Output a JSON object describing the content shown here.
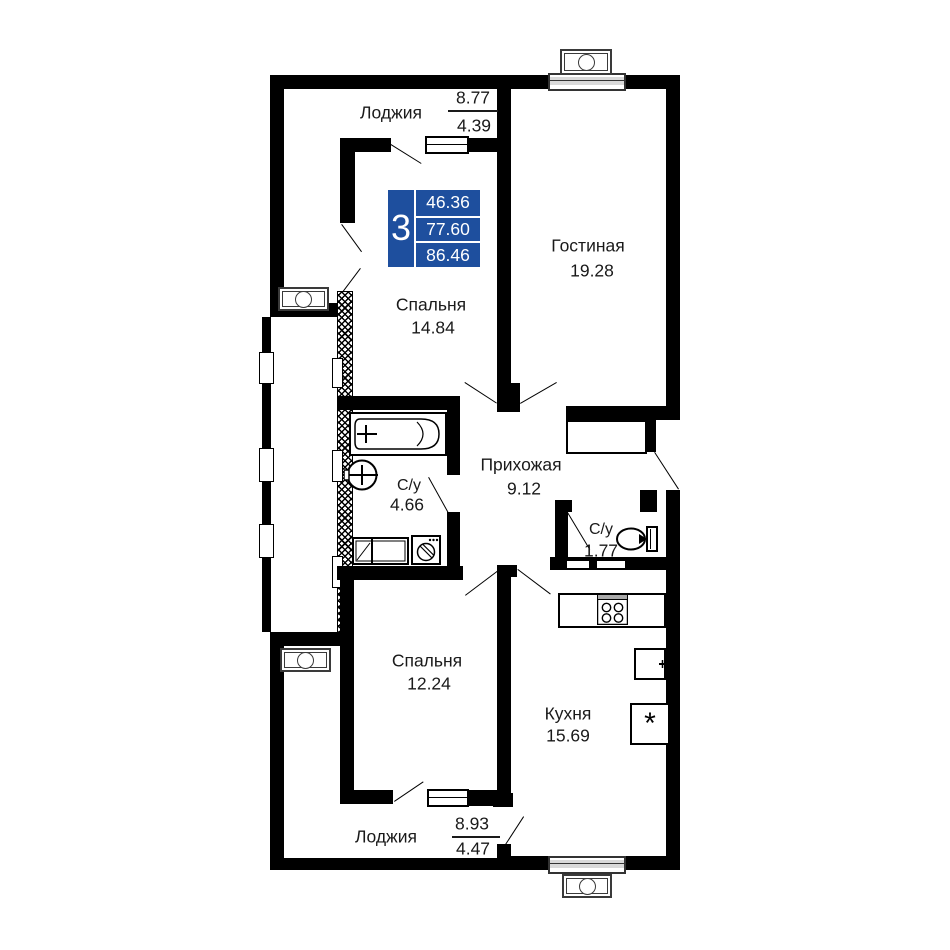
{
  "palette": {
    "wall": "#000000",
    "accent_blue": "#1e4f9e",
    "window_fill": "#d9d9d9"
  },
  "info_box": {
    "rooms_count": "3",
    "areas": [
      "46.36",
      "77.60",
      "86.46"
    ]
  },
  "rooms": {
    "loggia_top": {
      "name": "Лоджия",
      "area_full": "8.77",
      "area_reduced": "4.39"
    },
    "living": {
      "name": "Гостиная",
      "area": "19.28"
    },
    "bedroom1": {
      "name": "Спальня",
      "area": "14.84"
    },
    "bathroom": {
      "name": "С/у",
      "area": "4.66"
    },
    "hallway": {
      "name": "Прихожая",
      "area": "9.12"
    },
    "wc": {
      "name": "С/у",
      "area": "1.77"
    },
    "bedroom2": {
      "name": "Спальня",
      "area": "12.24"
    },
    "kitchen": {
      "name": "Кухня",
      "area": "15.69"
    },
    "loggia_bottom": {
      "name": "Лоджия",
      "area_full": "8.93",
      "area_reduced": "4.47"
    }
  },
  "symbols": {
    "fridge": "*"
  }
}
